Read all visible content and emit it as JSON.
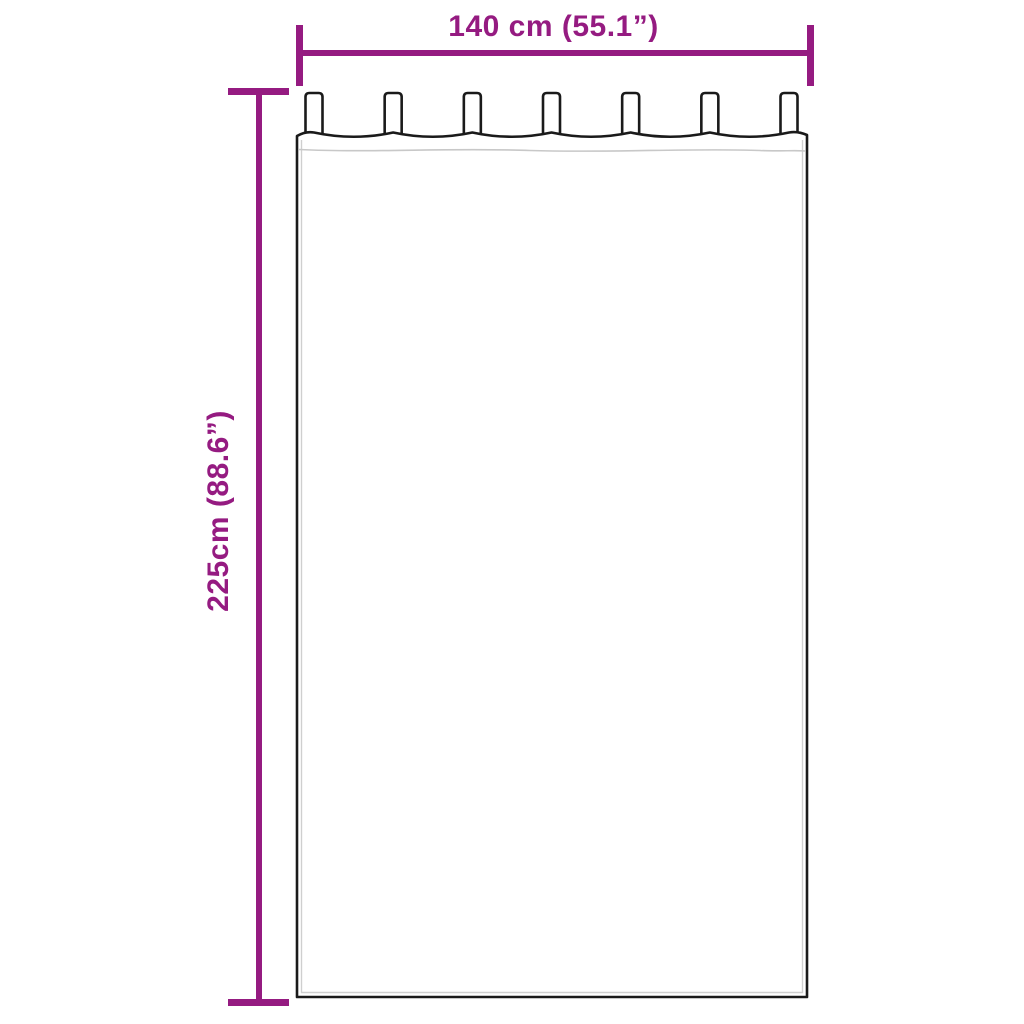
{
  "colors": {
    "accent": "#951B81",
    "outline": "#1A1A1A",
    "seam": "#C8C8C8",
    "background": "#FFFFFF"
  },
  "diagram": {
    "kind": "curtain-dimension-diagram",
    "width_label": "140 cm (55.1”)",
    "height_label": "225cm (88.6”)",
    "tab_count": 7
  }
}
